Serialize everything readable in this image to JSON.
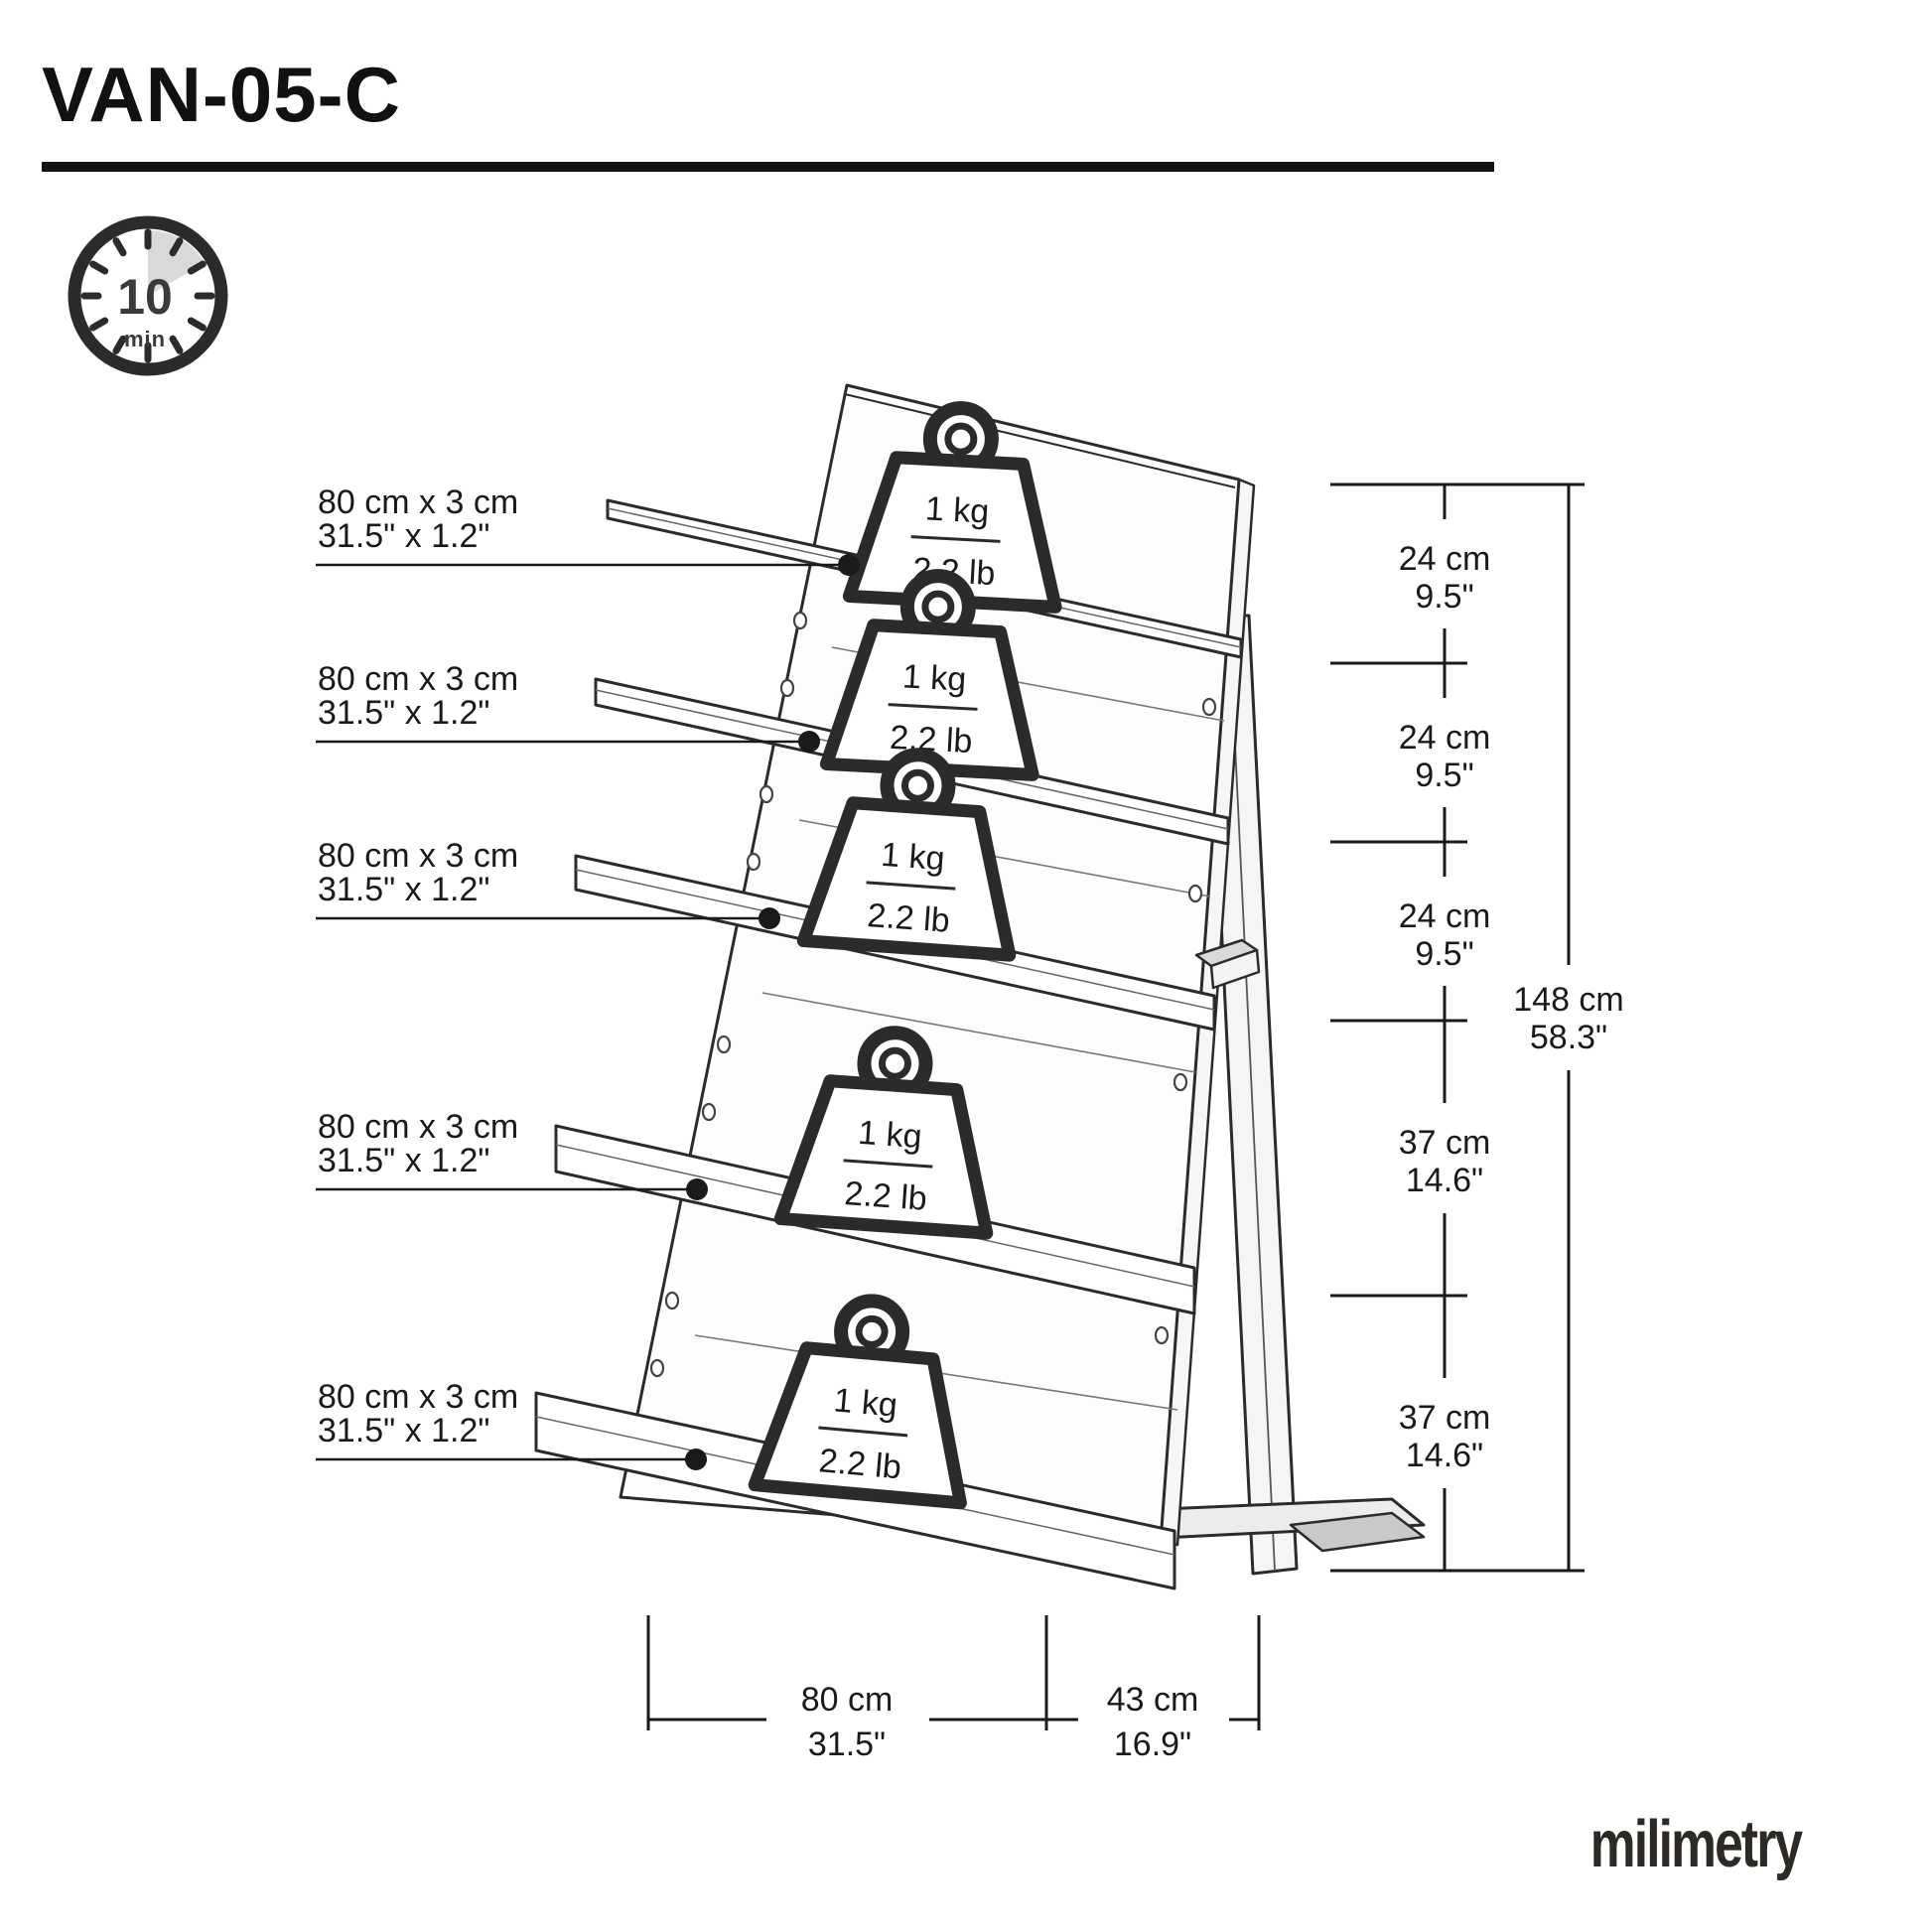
{
  "title": "VAN-05-C",
  "time_badge": {
    "value": "10",
    "unit": "min"
  },
  "shelf_labels": [
    {
      "size_metric": "80 cm x 3 cm",
      "size_imperial": "31.5\" x 1.2\""
    },
    {
      "size_metric": "80 cm x 3 cm",
      "size_imperial": "31.5\" x 1.2\""
    },
    {
      "size_metric": "80 cm x 3 cm",
      "size_imperial": "31.5\" x 1.2\""
    },
    {
      "size_metric": "80 cm x 3 cm",
      "size_imperial": "31.5\" x 1.2\""
    },
    {
      "size_metric": "80 cm x 3 cm",
      "size_imperial": "31.5\" x 1.2\""
    }
  ],
  "weights": [
    {
      "metric": "1 kg",
      "imperial": "2.2 lb"
    },
    {
      "metric": "1 kg",
      "imperial": "2.2 lb"
    },
    {
      "metric": "1 kg",
      "imperial": "2.2 lb"
    },
    {
      "metric": "1 kg",
      "imperial": "2.2 lb"
    },
    {
      "metric": "1 kg",
      "imperial": "2.2 lb"
    }
  ],
  "right_dimensions": {
    "segments": [
      {
        "metric": "24 cm",
        "imperial": "9.5\""
      },
      {
        "metric": "24 cm",
        "imperial": "9.5\""
      },
      {
        "metric": "24 cm",
        "imperial": "9.5\""
      },
      {
        "metric": "37 cm",
        "imperial": "14.6\""
      },
      {
        "metric": "37 cm",
        "imperial": "14.6\""
      }
    ],
    "total": {
      "metric": "148 cm",
      "imperial": "58.3\""
    }
  },
  "bottom_dimensions": {
    "width": {
      "metric": "80 cm",
      "imperial": "31.5\""
    },
    "depth": {
      "metric": "43 cm",
      "imperial": "16.9\""
    }
  },
  "brand": "milimetry",
  "colors": {
    "line": "#2b2b2b",
    "accent_gray": "#d9d9d9",
    "panel": "#fdfdfd"
  }
}
